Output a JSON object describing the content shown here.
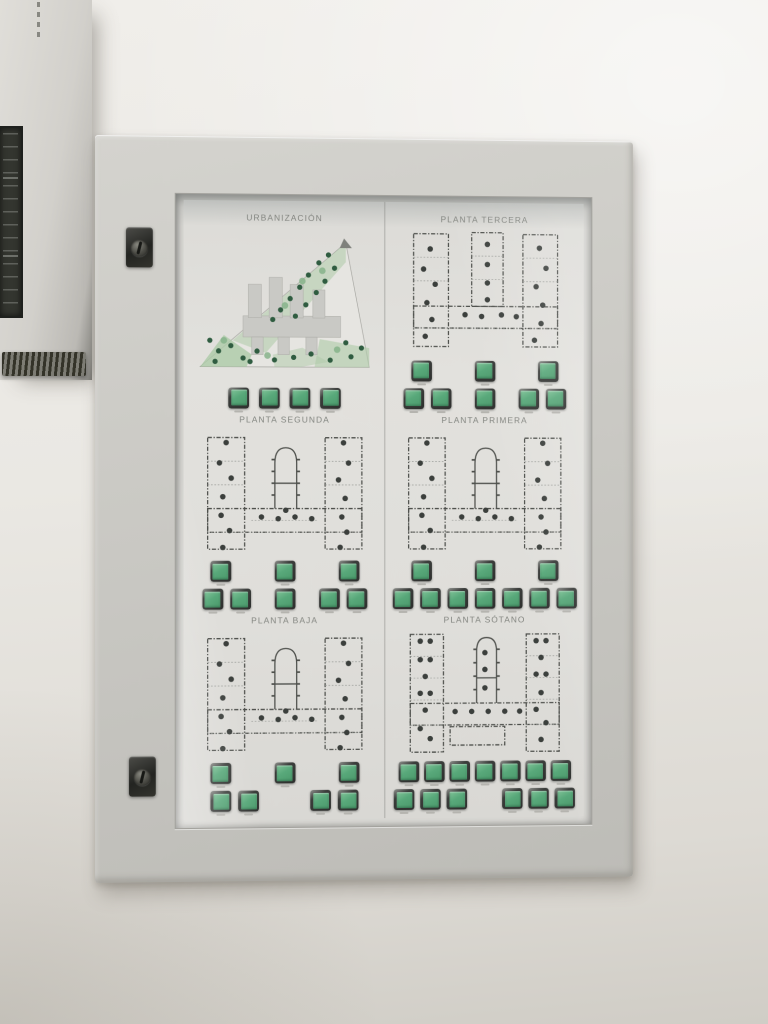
{
  "wall": {
    "top_color": "#f0eeea",
    "bottom_color": "#d0cdc6"
  },
  "adjacent_cabinet": {
    "parts": [
      "dark-mimic-display",
      "vent-grille",
      "mounting-dashes"
    ]
  },
  "panel": {
    "locks": [
      "cam-lock-top",
      "cam-lock-bottom"
    ],
    "colors": {
      "line": "#4e504c",
      "line_light": "#9b9d99",
      "dot": "#3b3f3c",
      "tree_dark": "#2f5c40",
      "tree_light": "#86b389",
      "green_light": "#adcaa7",
      "building": "#c9c9c5",
      "site_fill": "#e6e5e1",
      "title": "#82847f",
      "button_face": "#58a87a",
      "button_bezel": "#33342f"
    },
    "sections": [
      {
        "id": "urbanizacion",
        "title": "URBANIZACIÓN",
        "plan": "site",
        "rows": [
          {
            "groups": [
              4
            ],
            "gap": 10,
            "group_gap": 10
          }
        ]
      },
      {
        "id": "planta-tercera",
        "title": "PLANTA TERCERA",
        "plan": "wings3",
        "rows": [
          {
            "groups": [
              1,
              1,
              1
            ],
            "gap": 7,
            "group_gap": 44
          },
          {
            "groups": [
              2,
              1,
              2
            ],
            "gap": 7,
            "group_gap": 24
          }
        ]
      },
      {
        "id": "planta-segunda",
        "title": "PLANTA SEGUNDA",
        "plan": "chapel",
        "rows": [
          {
            "groups": [
              1,
              1,
              1
            ],
            "gap": 7,
            "group_gap": 44
          },
          {
            "groups": [
              2,
              1,
              2
            ],
            "gap": 7,
            "group_gap": 24
          }
        ]
      },
      {
        "id": "planta-primera",
        "title": "PLANTA PRIMERA",
        "plan": "chapel",
        "rows": [
          {
            "groups": [
              1,
              1,
              1
            ],
            "gap": 7,
            "group_gap": 44
          },
          {
            "groups": [
              7
            ],
            "gap": 7,
            "group_gap": 7
          }
        ]
      },
      {
        "id": "planta-baja",
        "title": "PLANTA BAJA",
        "plan": "chapel",
        "rows": [
          {
            "groups": [
              1,
              1,
              1
            ],
            "gap": 7,
            "group_gap": 44
          },
          {
            "groups": [
              2,
              2
            ],
            "gap": 7,
            "group_gap": 52
          }
        ]
      },
      {
        "id": "planta-sotano",
        "title": "PLANTA SÓTANO",
        "plan": "chapelTall",
        "rows": [
          {
            "groups": [
              7
            ],
            "gap": 5,
            "group_gap": 5
          },
          {
            "groups": [
              3,
              3
            ],
            "gap": 6,
            "group_gap": 36
          }
        ]
      }
    ]
  }
}
